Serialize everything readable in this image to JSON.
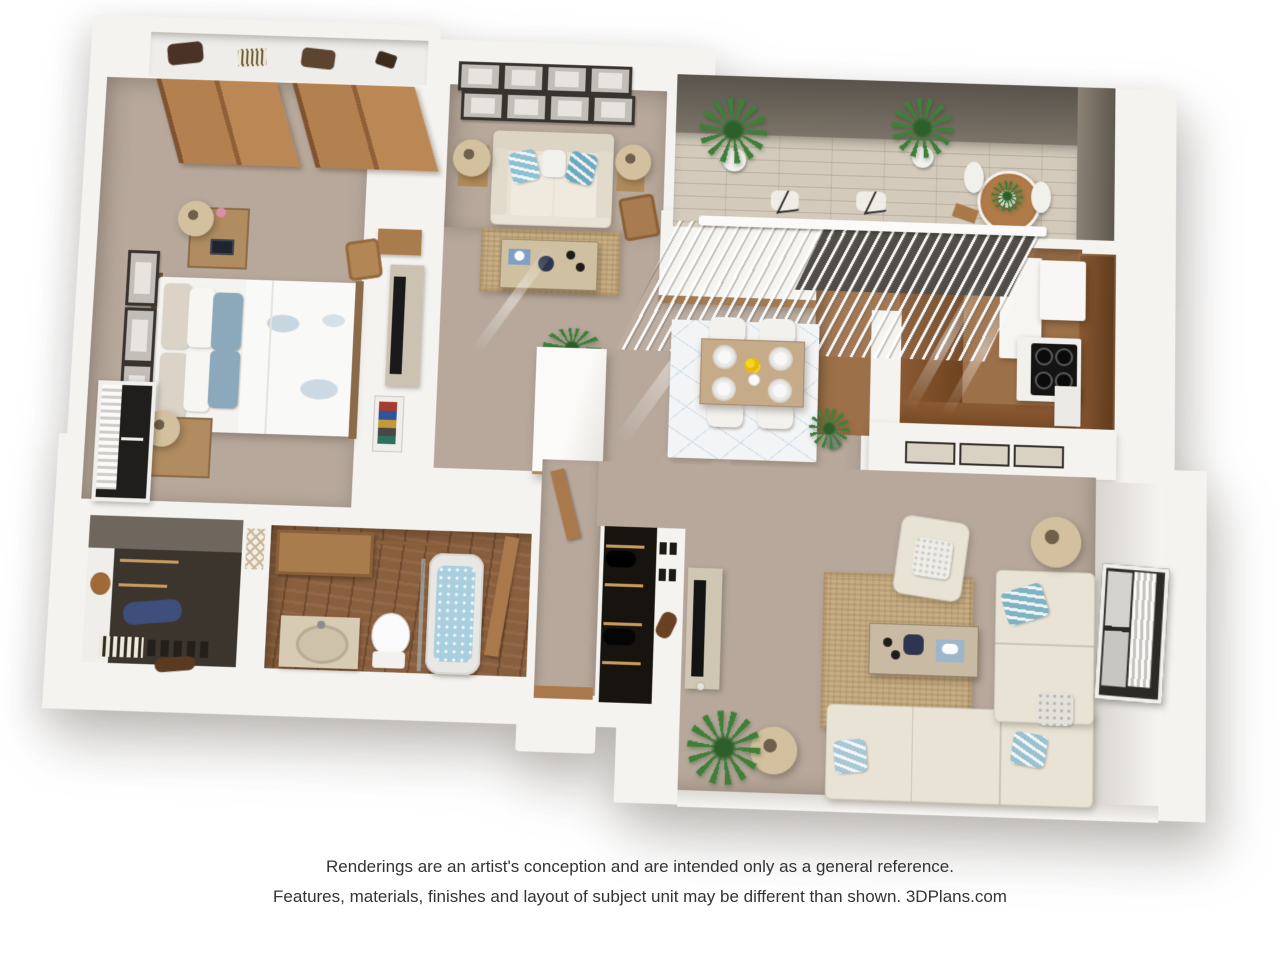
{
  "footer": {
    "line1": "Renderings are an artist's conception and are intended only as a general reference.",
    "line2": "Features, materials, finishes and layout of subject unit may be different than shown. 3DPlans.com"
  },
  "palette": {
    "wall": "#f4f3f0",
    "carpet": "#b7a89b",
    "jute": "#c8ae85",
    "cream": "#e9e3d5",
    "woodmid": "#a97c4e",
    "walnut": "#8a5f3e",
    "kfloor": "#9c7049",
    "counter": "#7c4e29",
    "balcfloor": "#d3cabb",
    "balcwall": "#625b53",
    "rugwhite": "#f3f4f5",
    "blue": "#8ca8bb",
    "teal": "#7fb3c4",
    "navy": "#2e3550",
    "green": "#3e8038",
    "water": "#a9cede",
    "dark": "#17130e",
    "text": "#333333"
  },
  "scene": {
    "type": "3d-floor-plan",
    "rooms": [
      {
        "name": "bedroom",
        "furniture": [
          "double-bed-blue-white-bedding",
          "two-nightstands-with-lamps",
          "sliding-door-closet-with-bags-shelf",
          "wall-frames",
          "window-with-blinds",
          "tv-console",
          "bookshelf",
          "desk-and-chair"
        ]
      },
      {
        "name": "den",
        "furniture": [
          "loveseat-with-blue-pillows",
          "two-side-lamps",
          "coffee-table",
          "jute-rug",
          "gallery-of-eight-frames",
          "wooden-chair"
        ]
      },
      {
        "name": "balcony",
        "furniture": [
          "two-potted-plants",
          "bistro-table-with-plant",
          "two-chairs"
        ]
      },
      {
        "name": "kitchen",
        "furniture": [
          "fridge",
          "stove-four-burners",
          "white-cabinet",
          "l-shaped-brown-counter",
          "vertical-blinds-slider",
          "pass-through-half-wall"
        ]
      },
      {
        "name": "dining-area",
        "furniture": [
          "table-four-place-settings",
          "four-white-chairs",
          "yellow-flower-centerpiece",
          "patterned-white-rug",
          "corner-plant",
          "white-storage-column"
        ]
      },
      {
        "name": "living-room",
        "furniture": [
          "l-shaped-sectional-sofa",
          "armchair",
          "two-floor-lamps",
          "coffee-table",
          "jute-rug",
          "tv-console",
          "fern-plant",
          "window-with-blinds"
        ]
      },
      {
        "name": "bathroom",
        "furniture": [
          "vanity-sink",
          "toilet",
          "soaking-tub",
          "glass-panel",
          "wood-shelf",
          "door"
        ]
      },
      {
        "name": "walk-in-closet",
        "furniture": [
          "shoe-rows",
          "striped-box",
          "blue-garment",
          "basket",
          "lattice-nook"
        ]
      },
      {
        "name": "entry",
        "furniture": [
          "coat-closet-with-shoes",
          "door-threshold",
          "stoop"
        ]
      }
    ]
  }
}
